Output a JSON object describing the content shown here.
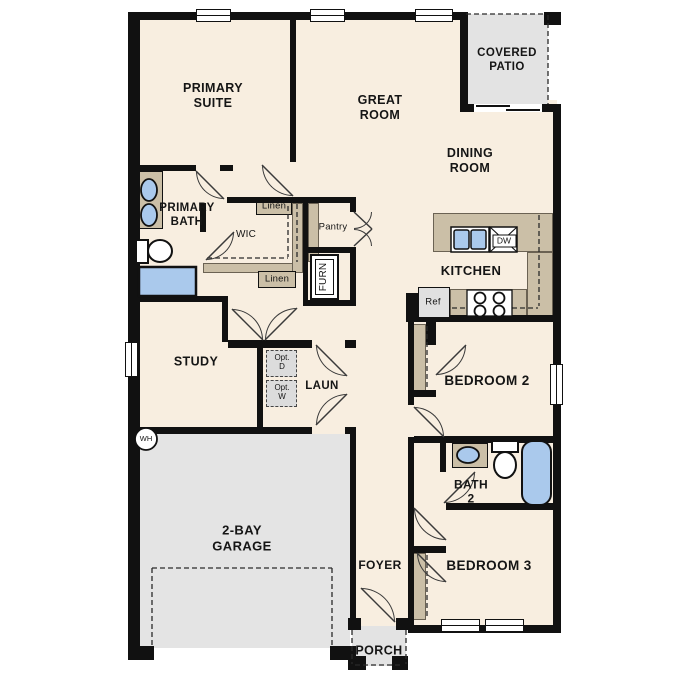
{
  "title": "single-story floor plan",
  "rooms": {
    "primary_suite": {
      "line1": "PRIMARY",
      "line2": "SUITE"
    },
    "great_room": {
      "line1": "GREAT",
      "line2": "ROOM"
    },
    "covered_patio": {
      "line1": "COVERED",
      "line2": "PATIO"
    },
    "dining_room": {
      "line1": "DINING",
      "line2": "ROOM"
    },
    "primary_bath": {
      "line1": "PRIMARY",
      "line2": "BATH"
    },
    "wic": {
      "line1": "WIC"
    },
    "kitchen": {
      "line1": "KITCHEN"
    },
    "study": {
      "line1": "STUDY"
    },
    "laundry": {
      "line1": "LAUN"
    },
    "garage": {
      "line1": "2-BAY",
      "line2": "GARAGE"
    },
    "bedroom2": {
      "line1": "BEDROOM 2"
    },
    "bath2": {
      "line1": "BATH",
      "line2": "2"
    },
    "bedroom3": {
      "line1": "BEDROOM 3"
    },
    "foyer": {
      "line1": "FOYER"
    },
    "porch": {
      "line1": "PORCH"
    }
  },
  "features": {
    "linen_top": "Linen",
    "linen_bottom": "Linen",
    "pantry": "Pantry",
    "furnace": "FURN",
    "dishwasher": "DW",
    "refrigerator": "Ref",
    "water_heater": "WH",
    "opt_dryer": {
      "line1": "Opt.",
      "line2": "D"
    },
    "opt_washer": {
      "line1": "Opt.",
      "line2": "W"
    }
  },
  "colors": {
    "floor": "#f8eee0",
    "wall": "#111111",
    "counter": "#cbbfa7",
    "garage": "#e4e4e4",
    "patio": "#e3e3e3",
    "fixture_blue": "#aac9ec",
    "appliance": "#e0e0e0",
    "outline": "#3a3a3a"
  }
}
